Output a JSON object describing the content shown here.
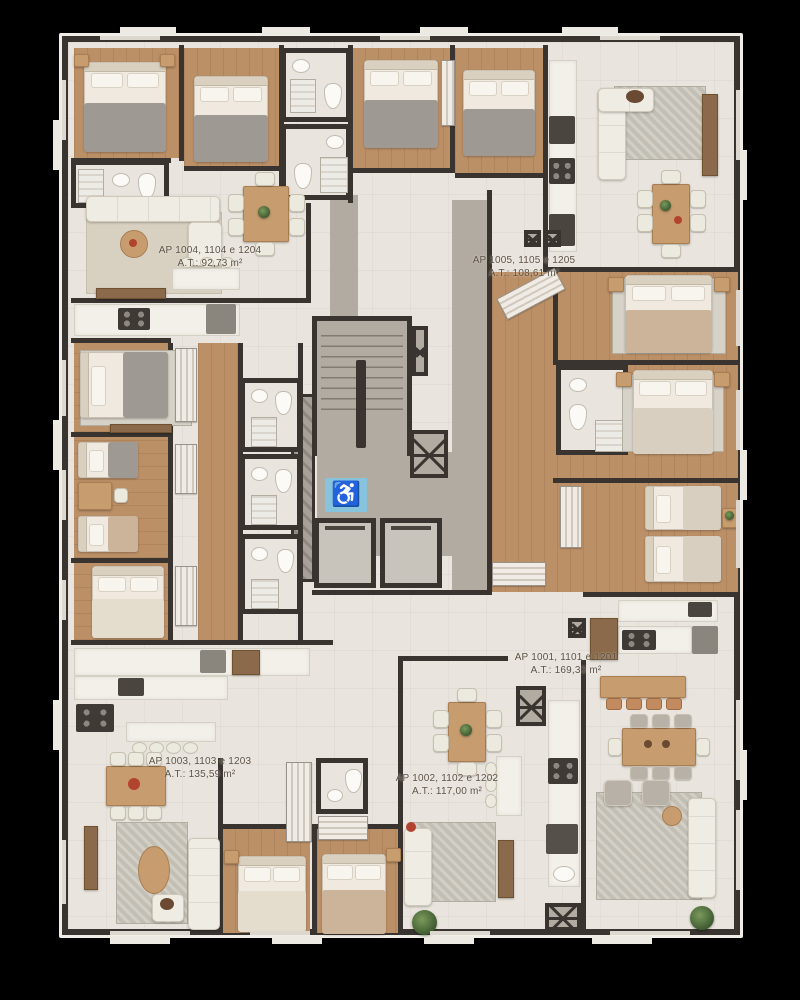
{
  "plan": {
    "type": "residential-floor-plan",
    "units_per_floor": 5
  },
  "apartments": [
    {
      "label": "AP 1004, 1104 e 1204",
      "area": "A.T.: 92,73 m²"
    },
    {
      "label": "AP 1005, 1105 e 1205",
      "area": "A.T.: 108,61 m²"
    },
    {
      "label": "AP 1001, 1101 e 1201",
      "area": "A.T.: 169,33 m²"
    },
    {
      "label": "AP 1003, 1103 e 1203",
      "area": "A.T.: 135,59 m²"
    },
    {
      "label": "AP 1002, 1102 e 1202",
      "area": "A.T.: 117,00 m²"
    }
  ],
  "core": {
    "accessible_symbol": "♿"
  },
  "colors": {
    "background": "#000000",
    "wall": "#3a3430",
    "floor_cream": "#e9e4dd",
    "floor_wood": "#bc9067",
    "floor_gray": "#b2aba2",
    "accessible_blue": "#87c3dc",
    "counter_marble": "#f3f0e9",
    "wood_furniture": "#c79d6f",
    "label_text": "#5d5246"
  }
}
